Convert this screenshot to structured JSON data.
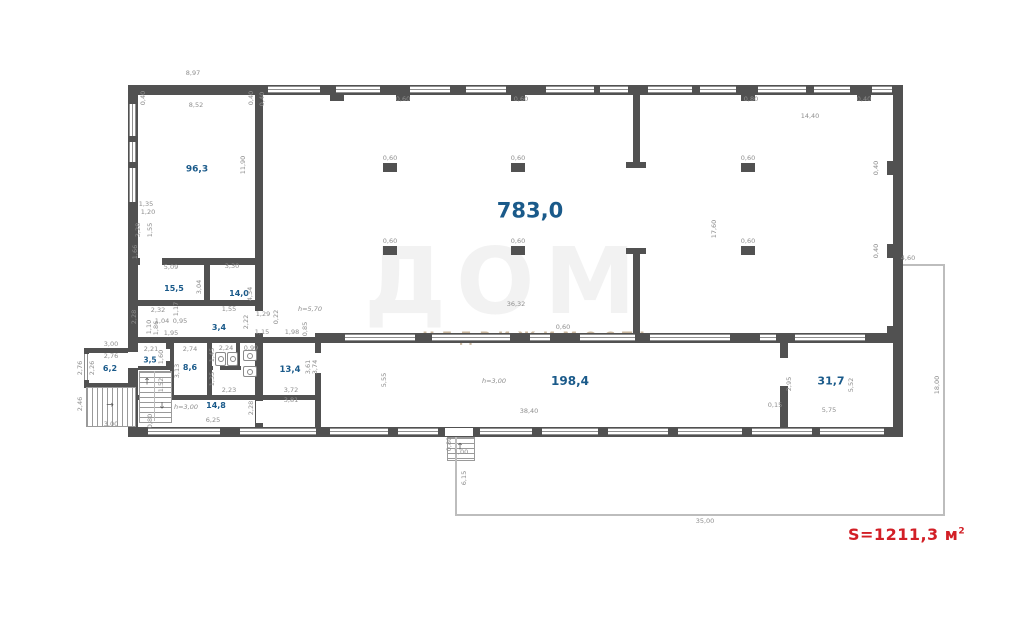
{
  "plan": {
    "total_area": {
      "prefix": "S=1211,3 м",
      "sup": "2"
    },
    "watermark_big": "ДОМ",
    "watermark_small": "НЕДВИЖИМОСТЬ",
    "colors": {
      "wall": "#515151",
      "area_label": "#1a5a8a",
      "dim_label": "#8e8e8e",
      "total_red": "#d21f26"
    }
  },
  "icons": {
    "arrow_up": "↑",
    "arrow_down": "↓",
    "arrow_right": "→"
  },
  "areas": [
    "96,3",
    "783,0",
    "15,5",
    "14,0",
    "3,4",
    "3,5",
    "6,2",
    "8,6",
    "13,4",
    "14,8",
    "198,4",
    "31,7"
  ],
  "heights": [
    "h=5,70",
    "h=3,00",
    "h=3,00"
  ],
  "dims": [
    "8,97",
    "8,52",
    "11,90",
    "0,40",
    "0,40",
    "1,35",
    "1,20",
    "3,28",
    "1,55",
    "1,66",
    "5,09",
    "3,30",
    "3,04",
    "4,34",
    "2,32",
    "1,17",
    "2,28",
    "1,04",
    "0,95",
    "1,10",
    "1,86",
    "1,95",
    "1,55",
    "2,22",
    "1,29",
    "0,22",
    "1,15",
    "1,98",
    "0,85",
    "3,00",
    "2,76",
    "2,76",
    "2,26",
    "2,46",
    "3,00",
    "0,80",
    "2,21",
    "1,60",
    "2,74",
    "3,13",
    "1,52",
    "1,45",
    "2,24",
    "0,99",
    "1,35",
    "2,23",
    "6,25",
    "2,28",
    "3,72",
    "3,81",
    "3,61",
    "3,74",
    "5,55",
    "38,40",
    "2,95",
    "0,15",
    "5,75",
    "5,52",
    "36,32",
    "14,40",
    "17,60",
    "4,60",
    "18,00",
    "35,00",
    "6,15",
    "0,80",
    "1,00",
    "0,60",
    "0,60",
    "0,60",
    "0,60",
    "0,60",
    "0,60",
    "0,60",
    "0,60",
    "0,80",
    "0,40",
    "0,40",
    "0,40",
    "0,60",
    "0,40"
  ]
}
